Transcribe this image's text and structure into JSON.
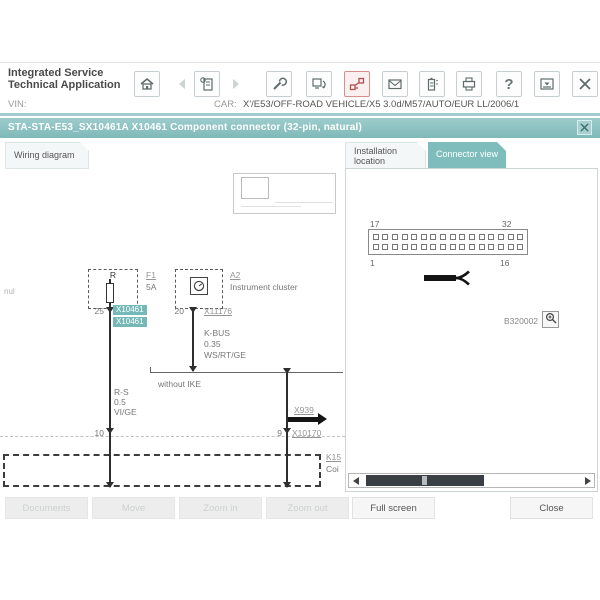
{
  "header": {
    "app_title_line1": "Integrated Service",
    "app_title_line2": "Technical Application",
    "help_glyph": "?",
    "toolbar_icons": [
      "home-icon",
      "back-icon",
      "operations-list-icon",
      "forward-icon",
      "workshop-icon",
      "connection-manager-icon",
      "vehicle-interface-icon",
      "messages-icon",
      "battery-icon",
      "print-icon",
      "help-icon",
      "minimize-icon",
      "close-icon"
    ]
  },
  "vin_row": {
    "vin_label": "VIN:",
    "car_label": "CAR:",
    "car_value": "X'/E53/OFF-ROAD VEHICLE/X5 3.0d/M57/AUTO/EUR LL/2006/1"
  },
  "title_bar": {
    "title": "STA-STA-E53_SX10461A X10461 Component connector (32-pin, natural)"
  },
  "tabs": {
    "wiring": "Wiring diagram",
    "installation_line1": "Installation",
    "installation_line2": "location",
    "connector": "Connector view"
  },
  "wiring_diagram": {
    "left_margin_note": "nul",
    "fuse": {
      "designator": "R",
      "ref": "F1",
      "rating": "5A",
      "pin": "25",
      "connector_labels": [
        "X10461",
        "X10461"
      ]
    },
    "cluster": {
      "ref": "A2",
      "name": "Instrument cluster",
      "pin": "20",
      "connector": "X11176",
      "wire": {
        "signal": "K-BUS",
        "cross_section": "0.35",
        "color": "WS/RT/GE"
      }
    },
    "branch_note": "without IKE",
    "left_wire": {
      "signal": "R-S",
      "cross_section": "0.5",
      "color": "VI/GE",
      "pin": "10"
    },
    "right_wire": {
      "ref_arrow": "X939",
      "pin": "9",
      "connector": "X10170"
    },
    "bottom_box": {
      "ref": "K15",
      "name": "Coi"
    }
  },
  "connector_view": {
    "pin_top_left": "17",
    "pin_top_right": "32",
    "pin_bottom_left": "1",
    "pin_bottom_right": "16",
    "rows": 2,
    "cols": 16,
    "image_ref": "B320002"
  },
  "footer": {
    "buttons": [
      {
        "label": "Documents",
        "enabled": false
      },
      {
        "label": "Move",
        "enabled": false
      },
      {
        "label": "Zoom in",
        "enabled": false
      },
      {
        "label": "Zoom out",
        "enabled": false
      },
      {
        "label": "Full screen",
        "enabled": true
      },
      {
        "label": "Close",
        "enabled": true
      }
    ]
  },
  "colors": {
    "teal": "#7fbdbd",
    "teal_light": "#a3cbcd",
    "accent_red": "#b05050",
    "wire": "#2e2e2e"
  }
}
